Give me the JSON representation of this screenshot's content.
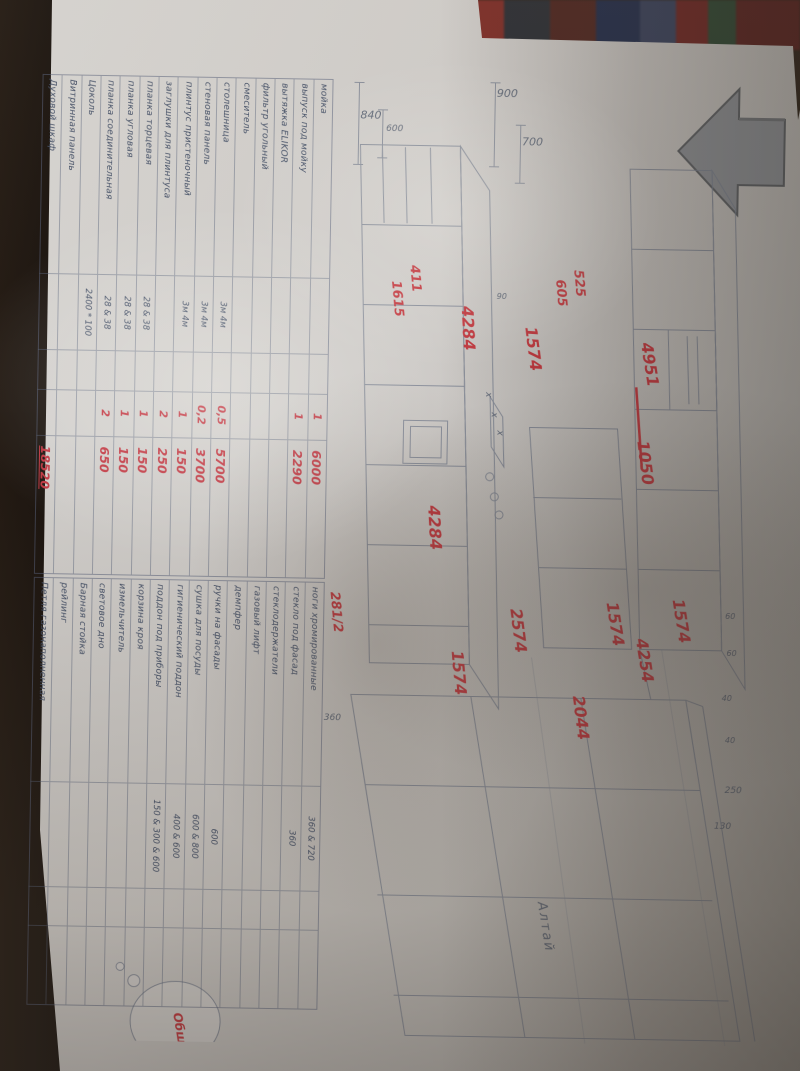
{
  "tables": {
    "estimate": {
      "rows": [
        {
          "name": "мойка",
          "qty": "1",
          "price": "6000"
        },
        {
          "name": "выпуск под мойку",
          "qty": "1",
          "price": "2290"
        },
        {
          "name": "вытяжка ELIKOR"
        },
        {
          "name": "фильтр угольный"
        },
        {
          "name": "смеситель"
        },
        {
          "name": "столешница",
          "size": "3м    4м",
          "qty": "0,5",
          "price": "5700"
        },
        {
          "name": "стеновая панель",
          "size": "3м    4м",
          "qty": "0,2",
          "price": "3700"
        },
        {
          "name": "плинтус пристеночный",
          "size": "3м    4м",
          "qty": "1",
          "price": "150"
        },
        {
          "name": "заглушки для плинтуса",
          "qty": "2",
          "price": "250"
        },
        {
          "name": "планка торцевая",
          "size": "28 & 38",
          "qty": "1",
          "price": "150"
        },
        {
          "name": "планка угловая",
          "size": "28 & 38",
          "qty": "1",
          "price": "150"
        },
        {
          "name": "планка соединительная",
          "size": "28 & 38",
          "qty": "2",
          "price": "650"
        },
        {
          "name": "Цоколь",
          "size": "2400 * 100"
        },
        {
          "name": "Витринная панель"
        },
        {
          "name": "Духовой шкаф",
          "price": "18520",
          "total": true
        }
      ]
    },
    "accessories": {
      "note": "281/2",
      "rows": [
        {
          "name": "ноги хромированные",
          "size": "360 & 720"
        },
        {
          "name": "стекло под фасад",
          "size": "360"
        },
        {
          "name": "стеклодержатели"
        },
        {
          "name": "газовый лифт"
        },
        {
          "name": "демпфер"
        },
        {
          "name": "ручки на фасады",
          "size": "600"
        },
        {
          "name": "сушка для посуды",
          "size": "600 & 800"
        },
        {
          "name": "гигиенический поддон",
          "size": "400 & 600"
        },
        {
          "name": "поддон под приборы",
          "size": "150 & 300 & 600"
        },
        {
          "name": "корзина кроя"
        },
        {
          "name": "измельчитель"
        },
        {
          "name": "световое дно"
        },
        {
          "name": "Барная стойка"
        },
        {
          "name": "рейлинг"
        },
        {
          "name": "Петля газонаполненная"
        }
      ]
    }
  },
  "drawing": {
    "dims": {
      "d840": "840",
      "d900": "900",
      "d700": "700",
      "d600": "600",
      "d360": "360",
      "d250": "250",
      "d130": "130",
      "d60a": "60",
      "d60b": "60",
      "d40a": "40",
      "d40b": "40",
      "d90": "90"
    },
    "red": {
      "r4284a": "4284",
      "r4284b": "4284",
      "r1574a": "1574",
      "r1574b": "1574",
      "r1574c": "1574",
      "r1574d": "1574",
      "r2574": "2574",
      "r2044": "2044",
      "r4254": "4254",
      "r1050": "1050",
      "r4951": "4951",
      "r411": "411",
      "r1615": "1615",
      "r525": "525",
      "r605": "605"
    },
    "marks": {
      "x1": "х",
      "x2": "х",
      "x3": "х"
    },
    "notes": {
      "altai": "Алтай",
      "bubble": "Общ."
    }
  },
  "colors": {
    "red_ink": "#c2353c",
    "pencil": "#5c6575",
    "paper": "#cdcac7"
  }
}
